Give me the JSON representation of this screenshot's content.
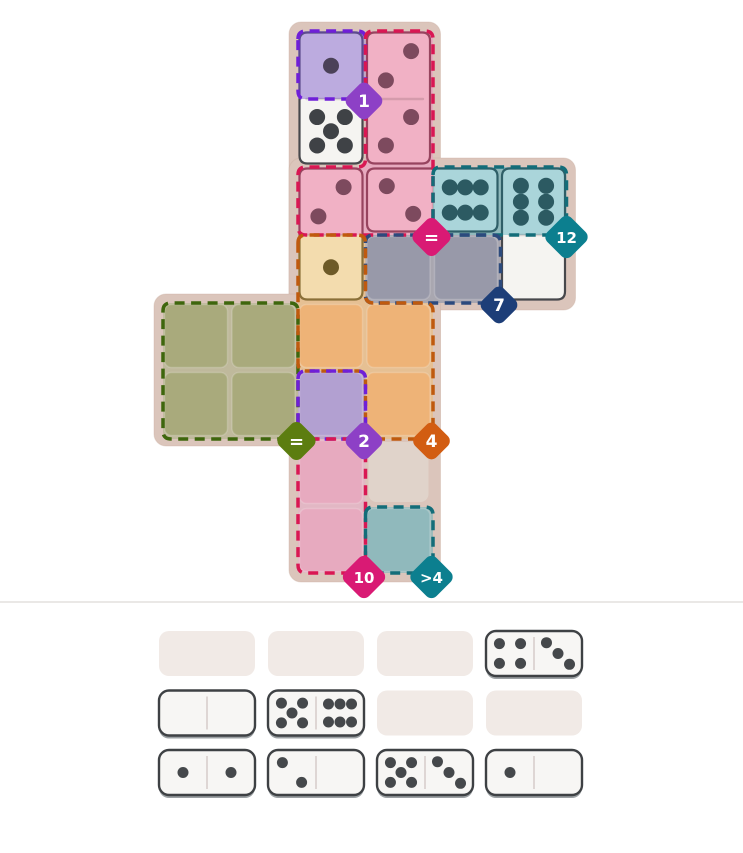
{
  "game": {
    "colors": {
      "page_bg": "#ffffff",
      "mat": "#dbc5bb",
      "mat_edge": "#c9ad9f",
      "plain_cell": "#e0d3ca",
      "tray_divider": "#e3e0dd"
    },
    "board": {
      "mat_blocks": [
        {
          "name": "mat-center-column"
        },
        {
          "name": "mat-middle-arm"
        },
        {
          "name": "mat-left-arm"
        }
      ],
      "plain_cells": [
        [
          3,
          6
        ]
      ],
      "regions": [
        {
          "name": "purple-1",
          "cells": [
            [
              2,
              0
            ]
          ],
          "border": "#6f1fd8",
          "fill": "#b2a0d1",
          "gap": "#bba9c9",
          "badge": {
            "text": "1",
            "color": "#8d40c6",
            "cell": [
              2,
              0
            ]
          }
        },
        {
          "name": "pink-equal",
          "cells": [
            [
              3,
              0
            ],
            [
              3,
              1
            ],
            [
              2,
              2
            ],
            [
              3,
              2
            ]
          ],
          "border": "#d91753",
          "fill": "#e7aabf",
          "gap": "#e7aabf",
          "badge": {
            "text": "=",
            "color": "#d91a74",
            "cell": [
              3,
              2
            ]
          }
        },
        {
          "name": "teal-12",
          "cells": [
            [
              4,
              2
            ],
            [
              5,
              2
            ]
          ],
          "border": "#136d79",
          "fill": "#90b9bc",
          "gap": "#90b9bc",
          "badge": {
            "text": "12",
            "color": "#0c7f8f",
            "cell": [
              5,
              2
            ]
          }
        },
        {
          "name": "navy-7",
          "cells": [
            [
              3,
              3
            ],
            [
              4,
              3
            ]
          ],
          "border": "#2c4a7d",
          "fill": "#9899a9",
          "gap": "#a9a7b0",
          "badge": {
            "text": "7",
            "color": "#1d3e78",
            "cell": [
              4,
              3
            ]
          }
        },
        {
          "name": "green-equal",
          "cells": [
            [
              0,
              4
            ],
            [
              1,
              4
            ],
            [
              0,
              5
            ],
            [
              1,
              5
            ]
          ],
          "border": "#3e660d",
          "fill": "#a9aa7c",
          "gap": "#bfb99c",
          "badge": {
            "text": "=",
            "color": "#5c7d10",
            "cell": [
              1,
              5
            ]
          }
        },
        {
          "name": "orange-4",
          "cells": [
            [
              2,
              3
            ],
            [
              2,
              4
            ],
            [
              3,
              4
            ],
            [
              3,
              5
            ]
          ],
          "border": "#bf5a0e",
          "fill": "#eeb377",
          "gap": "#e6c093",
          "badge": {
            "text": "4",
            "color": "#d25d12",
            "cell": [
              3,
              5
            ]
          }
        },
        {
          "name": "purple-2",
          "cells": [
            [
              2,
              5
            ]
          ],
          "border": "#6f1fd8",
          "fill": "#b2a0d1",
          "gap": "#bba9c9",
          "badge": {
            "text": "2",
            "color": "#8d40c6",
            "cell": [
              2,
              5
            ]
          }
        },
        {
          "name": "magenta-10",
          "cells": [
            [
              2,
              6
            ],
            [
              2,
              7
            ]
          ],
          "border": "#d91753",
          "fill": "#e7aabf",
          "gap": "#e2b7c4",
          "badge": {
            "text": "10",
            "color": "#d91a74",
            "cell": [
              2,
              7
            ]
          }
        },
        {
          "name": "teal-gt4",
          "cells": [
            [
              3,
              7
            ]
          ],
          "border": "#136d79",
          "fill": "#90b9bc",
          "gap": "#9fbcbb",
          "badge": {
            "text": ">4",
            "color": "#0c7f8f",
            "cell": [
              3,
              7
            ]
          }
        }
      ],
      "placed_dominoes": [
        {
          "name": "placed-domino-1-5",
          "cells": [
            [
              2,
              0
            ],
            [
              2,
              1
            ]
          ],
          "values": [
            1,
            5
          ],
          "tints": [
            "purple",
            "none"
          ]
        },
        {
          "name": "placed-domino-2-2",
          "cells": [
            [
              3,
              0
            ],
            [
              3,
              1
            ]
          ],
          "values": [
            2,
            2
          ],
          "tints": [
            "pink",
            "pink"
          ]
        },
        {
          "name": "placed-domino-2-1",
          "cells": [
            [
              2,
              2
            ],
            [
              2,
              3
            ]
          ],
          "values": [
            2,
            1
          ],
          "tints": [
            "pink",
            "orange"
          ]
        },
        {
          "name": "placed-domino-2-6",
          "cells": [
            [
              3,
              2
            ],
            [
              4,
              2
            ]
          ],
          "values": [
            2,
            6
          ],
          "tints": [
            "pink",
            "teal"
          ]
        },
        {
          "name": "placed-domino-6-0",
          "cells": [
            [
              5,
              2
            ],
            [
              5,
              3
            ]
          ],
          "values": [
            6,
            0
          ],
          "tints": [
            "teal",
            "none"
          ]
        }
      ],
      "tints": {
        "purple": {
          "fill": "#bcabdf",
          "stroke": "#5c4b8c",
          "pip": "#4b4158"
        },
        "pink": {
          "fill": "#f1b1c5",
          "stroke": "#97445f",
          "pip": "#7d4a5e"
        },
        "teal": {
          "fill": "#aad5da",
          "stroke": "#2f5f68",
          "pip": "#2c5a62"
        },
        "orange": {
          "fill": "#f3dcae",
          "stroke": "#8a7038",
          "pip": "#6d5a28"
        },
        "none": {
          "fill": "#f5f4f1",
          "stroke": "#47484c",
          "pip": "#3f4246"
        }
      }
    },
    "tray": {
      "empty_color": "#f1eae6",
      "tile": {
        "fill": "#f7f6f4",
        "stroke": "#3e4144",
        "pip": "#45484b",
        "shadow": "#9ba0a3",
        "divider": "#d8cecb"
      },
      "slots": [
        {
          "state": "empty"
        },
        {
          "state": "empty"
        },
        {
          "state": "empty"
        },
        {
          "state": "tile",
          "values": [
            4,
            3
          ]
        },
        {
          "state": "tile",
          "values": [
            0,
            0
          ]
        },
        {
          "state": "tile",
          "values": [
            5,
            6
          ]
        },
        {
          "state": "empty"
        },
        {
          "state": "empty"
        },
        {
          "state": "tile",
          "values": [
            1,
            1
          ]
        },
        {
          "state": "tile",
          "values": [
            2,
            0
          ]
        },
        {
          "state": "tile",
          "values": [
            5,
            3
          ]
        },
        {
          "state": "tile",
          "values": [
            1,
            0
          ]
        }
      ]
    }
  }
}
